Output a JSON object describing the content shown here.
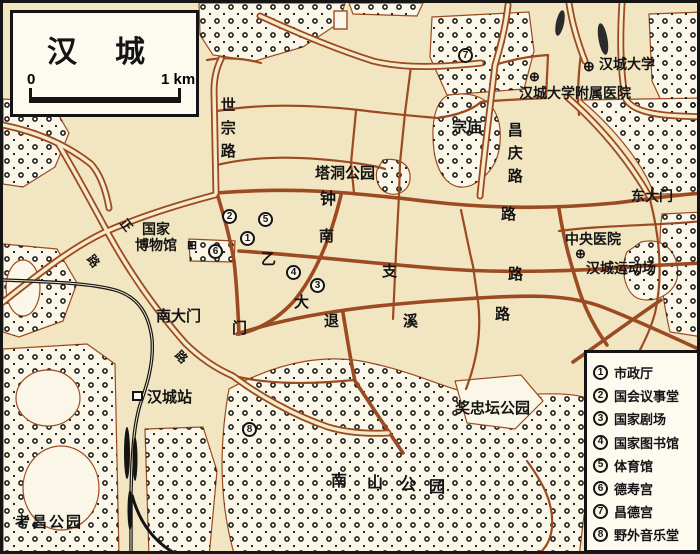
{
  "title_box": {
    "title": "汉城",
    "scale_left": "0",
    "scale_right": "1 km"
  },
  "legend": {
    "items": [
      {
        "num": "1",
        "label": "市政厅"
      },
      {
        "num": "2",
        "label": "国会议事堂"
      },
      {
        "num": "3",
        "label": "国家剧场"
      },
      {
        "num": "4",
        "label": "国家图书馆"
      },
      {
        "num": "5",
        "label": "体育馆"
      },
      {
        "num": "6",
        "label": "德寿宫"
      },
      {
        "num": "7",
        "label": "昌德宫"
      },
      {
        "num": "8",
        "label": "野外音乐堂"
      }
    ]
  },
  "roads": {
    "sejong_vertical": "世宗路",
    "changgyeong_vertical": "昌庆路",
    "jongno_char1": "钟",
    "jongno_char2": "路",
    "euljiro_char1": "乙",
    "euljiro_char2": "支",
    "euljiro_char3": "路",
    "toegyero_char1": "退",
    "toegyero_char2": "溪",
    "toegyero_char3": "路",
    "namdaemunro_char1": "南",
    "namdaemunro_char2": "大",
    "namdaemunro_char3": "门",
    "diag_char1": "正",
    "diag_char2": "路",
    "diag_char3": "路"
  },
  "places": {
    "tapdong_park": "塔洞公园",
    "jongmyo": "宗庙",
    "dongdaemun": "东大门",
    "central_hospital": "中央医院",
    "seoul_stadium": "汉城运动场",
    "national_museum_line1": "国家",
    "national_museum_line2": "博物馆",
    "namdaemun_gate": "南大门",
    "seoul_station": "汉城站",
    "seoul_university": "汉城大学",
    "university_hospital": "汉城大学附属医院",
    "jangchungdan_park": "奖忠坛公园",
    "namsan_c1": "南",
    "namsan_c2": "山",
    "namsan_c3": "公",
    "namsan_c4": "园",
    "gochang_park": "考昌公园"
  },
  "symbols": {
    "hospital_cross": "⊕",
    "university_mark": "⊕",
    "museum_mark": "⊞"
  },
  "colors": {
    "background": "#f1e5c2",
    "road_brown": "#9c4a21",
    "park_fill": "#fbf7e8",
    "railway_black": "#141414",
    "paper_white": "#fdfaf0"
  }
}
